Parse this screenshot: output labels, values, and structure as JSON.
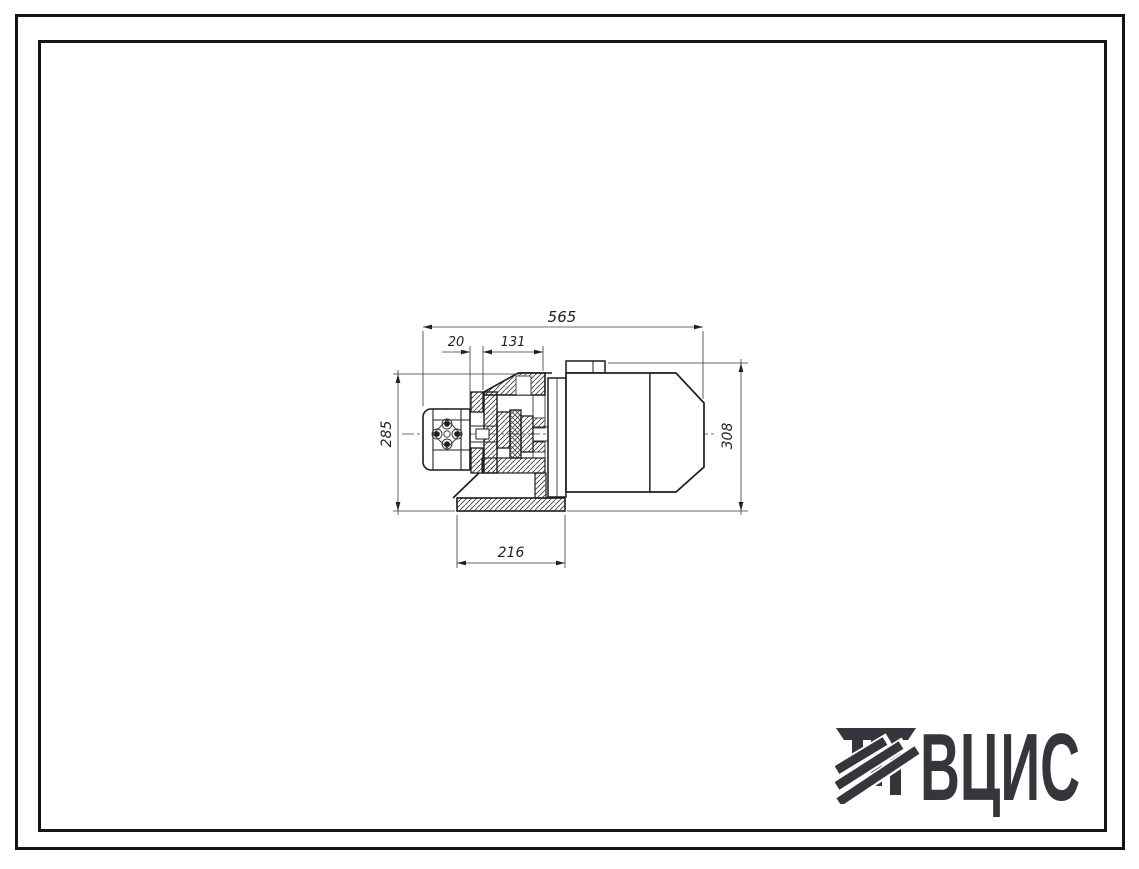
{
  "page": {
    "type": "scanned technical drawing sheet",
    "background": "#ffffff",
    "frame_color": "#141414",
    "ink_color": "#222222"
  },
  "drawing": {
    "subject": "sectional side view of a gear pump with coupling bracket and electric motor on a base plate",
    "dimensions": {
      "overall_length": "565",
      "pump_offset": "20",
      "bracket_length": "131",
      "left_height": "285",
      "motor_height": "308",
      "base_length": "216"
    }
  },
  "logo": {
    "text": "ВЦИС",
    "color": "#35353b",
    "icon": "column-with-diagonal-stripes"
  }
}
